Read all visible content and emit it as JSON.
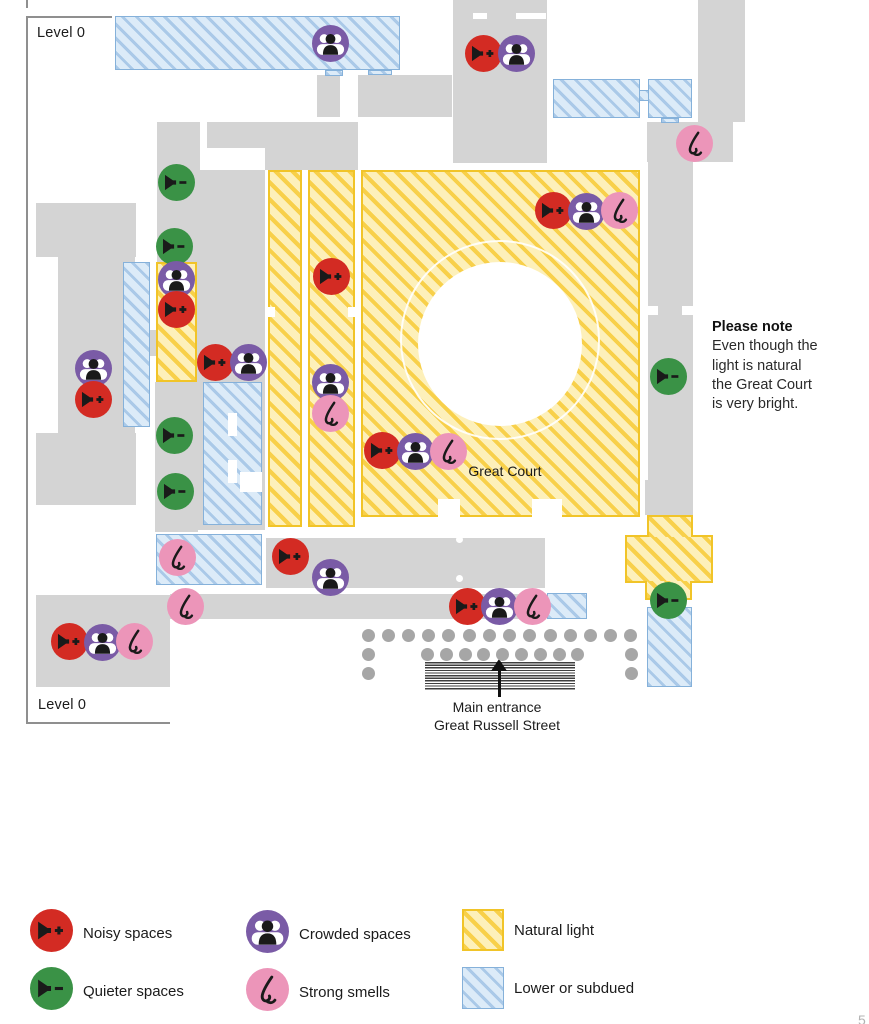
{
  "page": {
    "level_label_top": "Level 0",
    "level_label_bottom": "Level 0",
    "page_number": "5"
  },
  "map": {
    "great_court_label": "Great Court",
    "entrance_label_line1": "Main entrance",
    "entrance_label_line2": "Great Russell Street",
    "markers": [
      {
        "type": "crowded",
        "x": 330,
        "y": 43
      },
      {
        "type": "noisy",
        "x": 483,
        "y": 53
      },
      {
        "type": "crowded",
        "x": 516,
        "y": 53
      },
      {
        "type": "smells",
        "x": 694,
        "y": 143
      },
      {
        "type": "quieter",
        "x": 176,
        "y": 182
      },
      {
        "type": "noisy",
        "x": 553,
        "y": 210
      },
      {
        "type": "crowded",
        "x": 586,
        "y": 211
      },
      {
        "type": "smells",
        "x": 619,
        "y": 210
      },
      {
        "type": "quieter",
        "x": 174,
        "y": 246
      },
      {
        "type": "noisy",
        "x": 331,
        "y": 276
      },
      {
        "type": "crowded",
        "x": 176,
        "y": 279
      },
      {
        "type": "noisy",
        "x": 176,
        "y": 309
      },
      {
        "type": "noisy",
        "x": 215,
        "y": 362
      },
      {
        "type": "crowded",
        "x": 248,
        "y": 362
      },
      {
        "type": "crowded",
        "x": 93,
        "y": 368
      },
      {
        "type": "quieter",
        "x": 668,
        "y": 376
      },
      {
        "type": "crowded",
        "x": 330,
        "y": 382
      },
      {
        "type": "noisy",
        "x": 93,
        "y": 399
      },
      {
        "type": "smells",
        "x": 330,
        "y": 413
      },
      {
        "type": "quieter",
        "x": 174,
        "y": 435
      },
      {
        "type": "noisy",
        "x": 382,
        "y": 450
      },
      {
        "type": "crowded",
        "x": 415,
        "y": 451
      },
      {
        "type": "smells",
        "x": 448,
        "y": 451
      },
      {
        "type": "quieter",
        "x": 175,
        "y": 491
      },
      {
        "type": "noisy",
        "x": 290,
        "y": 556
      },
      {
        "type": "smells",
        "x": 177,
        "y": 557
      },
      {
        "type": "crowded",
        "x": 330,
        "y": 577
      },
      {
        "type": "quieter",
        "x": 668,
        "y": 600
      },
      {
        "type": "smells",
        "x": 185,
        "y": 606
      },
      {
        "type": "noisy",
        "x": 467,
        "y": 606
      },
      {
        "type": "crowded",
        "x": 499,
        "y": 606
      },
      {
        "type": "smells",
        "x": 532,
        "y": 606
      },
      {
        "type": "noisy",
        "x": 69,
        "y": 641
      },
      {
        "type": "crowded",
        "x": 102,
        "y": 642
      },
      {
        "type": "smells",
        "x": 134,
        "y": 641
      }
    ]
  },
  "note": {
    "title": "Please note",
    "lines": [
      "Even though the",
      "light is natural",
      "the Great Court",
      "is very bright."
    ]
  },
  "legend": {
    "items": [
      {
        "type": "noisy",
        "label": "Noisy spaces"
      },
      {
        "type": "quieter",
        "label": "Quieter spaces"
      },
      {
        "type": "crowded",
        "label": "Crowded spaces"
      },
      {
        "type": "smells",
        "label": "Strong smells"
      },
      {
        "type": "natural",
        "label": "Natural light"
      },
      {
        "type": "subdued",
        "label": "Lower or subdued"
      }
    ]
  },
  "colors": {
    "noisy": "#d32b23",
    "quieter": "#3a9246",
    "crowded": "#7a5ba6",
    "smells": "#ec95b9",
    "glyph": "#1a1a1a",
    "natural_bg": "#fdf0ba",
    "natural_stripe": "#f8d04a",
    "subdued_bg": "#dcebf8",
    "subdued_stripe": "#aac9e8",
    "room_grey": "#d4d4d4"
  }
}
